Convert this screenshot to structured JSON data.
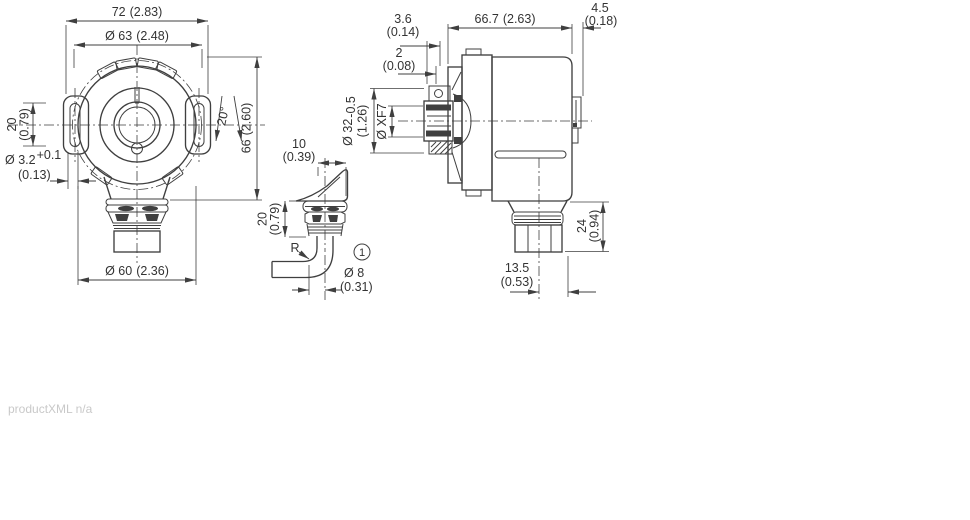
{
  "footer_note": "productXML n/a",
  "front_view": {
    "width": {
      "mm": "72",
      "in": "(2.83)"
    },
    "bolt_circle": {
      "mm": "Ø 63",
      "in": "(2.48)"
    },
    "slot_length": {
      "mm": "20",
      "in": "(0.79)"
    },
    "slot_width": {
      "mm": "Ø 3.2",
      "tol": "+0.1",
      "in": "(0.13)"
    },
    "slot_angle": {
      "deg": "20°"
    },
    "height": {
      "mm": "66",
      "in": "(2.60)"
    },
    "body_diameter": {
      "mm": "Ø 60",
      "in": "(2.36)"
    }
  },
  "cable_detail": {
    "exit_offset": {
      "mm": "10",
      "in": "(0.39)"
    },
    "gland_length": {
      "mm": "20",
      "in": "(0.79)"
    },
    "bend_radius": {
      "label": "R"
    },
    "callout": {
      "number": "1"
    },
    "cable_diameter": {
      "mm": "Ø 8",
      "in": "(0.31)"
    }
  },
  "side_view": {
    "flange_offset": {
      "mm": "3.6",
      "in": "(0.14)"
    },
    "hub_gap": {
      "mm": "2",
      "in": "(0.08)"
    },
    "body_length": {
      "mm": "66.7",
      "in": "(2.63)"
    },
    "rear_clearance": {
      "mm": "4.5",
      "in": "(0.18)"
    },
    "hub_diameter": {
      "mm": "Ø 32",
      "tol": "-0.5",
      "in": "(1.26)"
    },
    "shaft_bore": {
      "label": "Ø XF7"
    },
    "gland_height": {
      "mm": "24",
      "in": "(0.94)"
    },
    "gland_offset": {
      "mm": "13.5",
      "in": "(0.53)"
    }
  }
}
